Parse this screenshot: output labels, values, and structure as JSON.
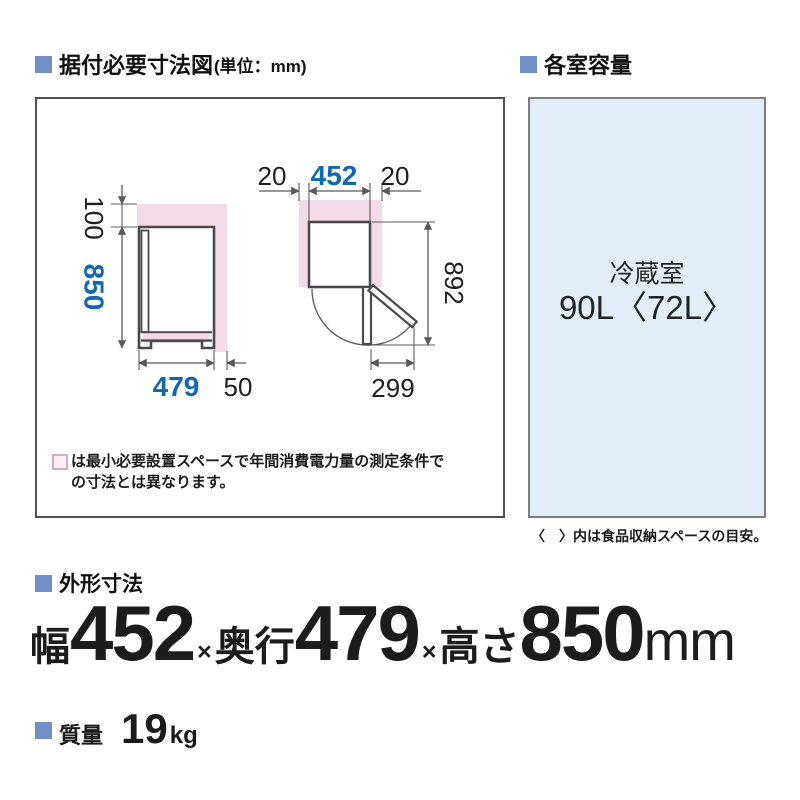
{
  "colors": {
    "section_bullet_blue": "#7190c6",
    "dimension_blue": "#1366b0",
    "clearance_pink": "#f3dae8",
    "capacity_box_bg": "#e3edf8",
    "outline_gray": "#4a4a4a"
  },
  "icons": {
    "section_bullet": "blue-square",
    "note_swatch": "pink-outline-square"
  },
  "sections": {
    "install": {
      "title": "据付必要寸法図",
      "unit": "(単位：mm)"
    },
    "capacity": {
      "title": "各室容量"
    },
    "outer": {
      "title": "外形寸法"
    },
    "weight": {
      "title": "質量",
      "value": "19",
      "unit": "kg"
    }
  },
  "diagram": {
    "side_view": {
      "top_clearance": "100",
      "height": "850",
      "depth": "479",
      "rear_clearance": "50"
    },
    "top_view": {
      "left_clearance": "20",
      "width": "452",
      "right_clearance": "20",
      "depth_door_open": "892",
      "door_swing": "299"
    },
    "note_line1": "は最小必要設置スペースで年間消費電力量の測定条件で",
    "note_line2": "の寸法とは異なります。"
  },
  "capacity_box": {
    "room_name": "冷蔵室",
    "volume": "90L〈72L〉",
    "caption": "〈　〉内は食品収納スペースの目安。"
  },
  "outer_dims": {
    "width_label": "幅",
    "width": "452",
    "times": "×",
    "depth_label": "奥行",
    "depth": "479",
    "height_label": "高さ",
    "height": "850",
    "unit": "mm"
  }
}
